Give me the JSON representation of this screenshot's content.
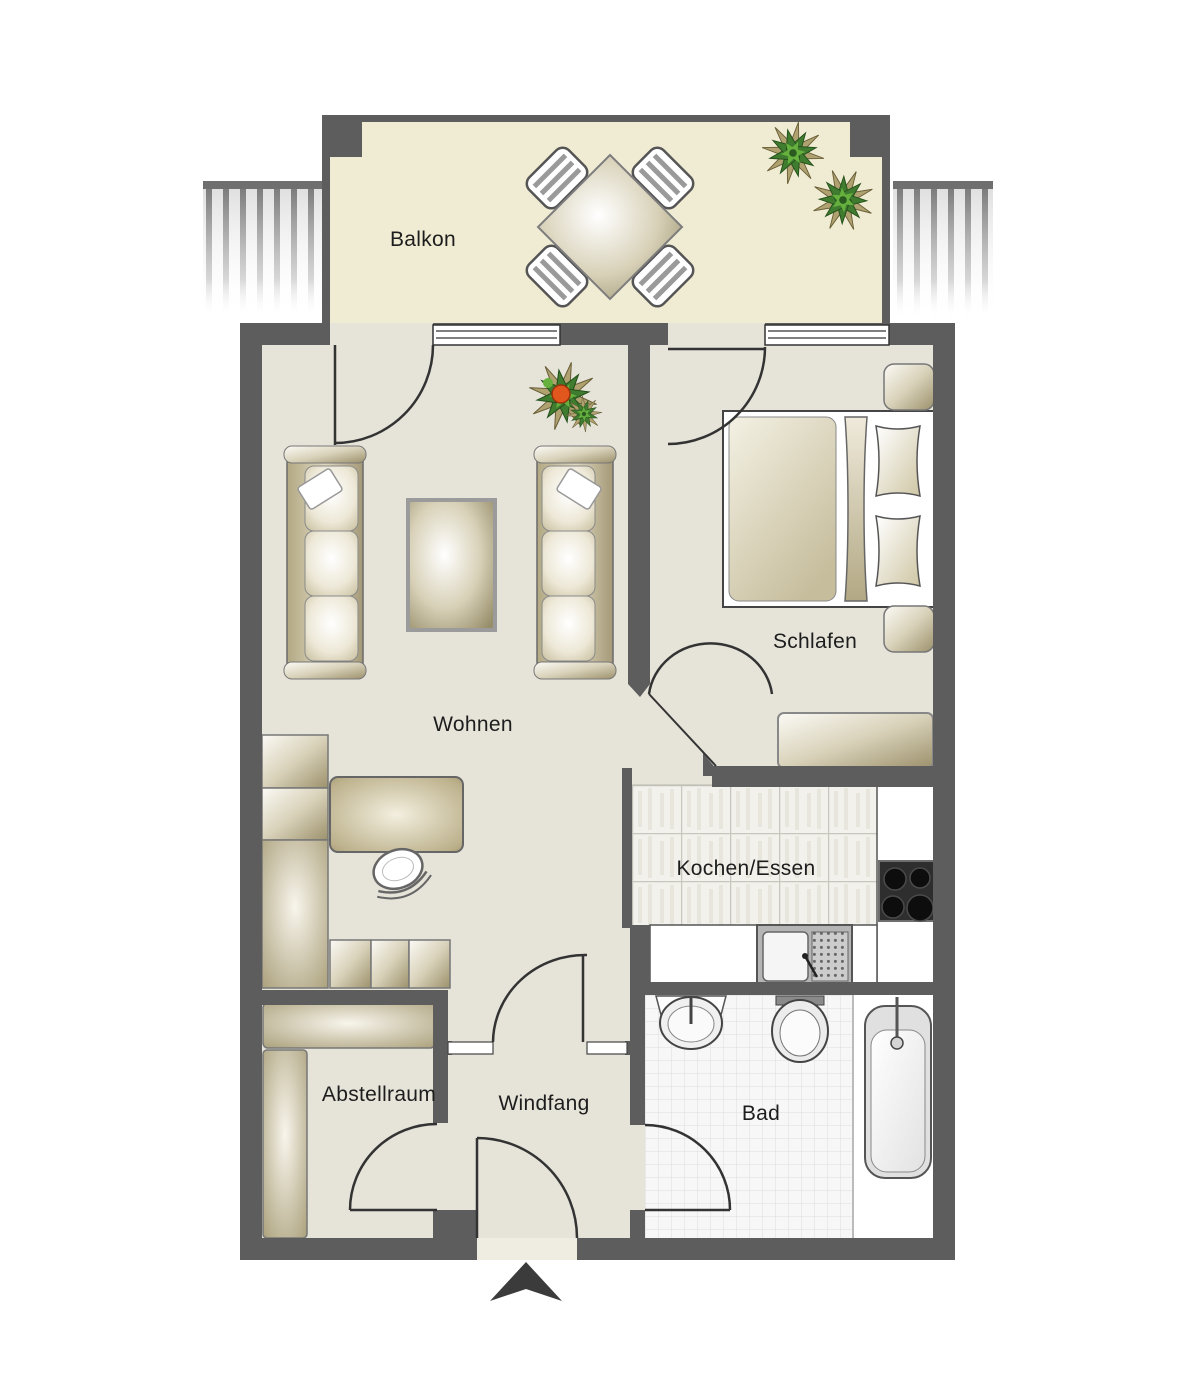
{
  "rooms": {
    "balkon": "Balkon",
    "wohnen": "Wohnen",
    "schlafen": "Schlafen",
    "kochen_essen": "Kochen/Essen",
    "abstellraum": "Abstellraum",
    "windfang": "Windfang",
    "bad": "Bad"
  },
  "colors": {
    "wall": "#5d5d5d",
    "interior_floor": "#e6e3d9",
    "balcony_floor": "#f0ebd3",
    "threshold": "#efece2",
    "furniture_tan": "#a89c74",
    "kitchen_tile": "#f3f1eb",
    "bath_tile": "#f7f7f7",
    "plant_green": "#3f7c2f",
    "flower_orange": "#e2571d",
    "stove_black": "#2e2e2e",
    "door_line": "#333333"
  },
  "icons": {
    "entrance": "entrance-arrow",
    "plant": "plant-icon",
    "door": "door-swing-arc"
  }
}
